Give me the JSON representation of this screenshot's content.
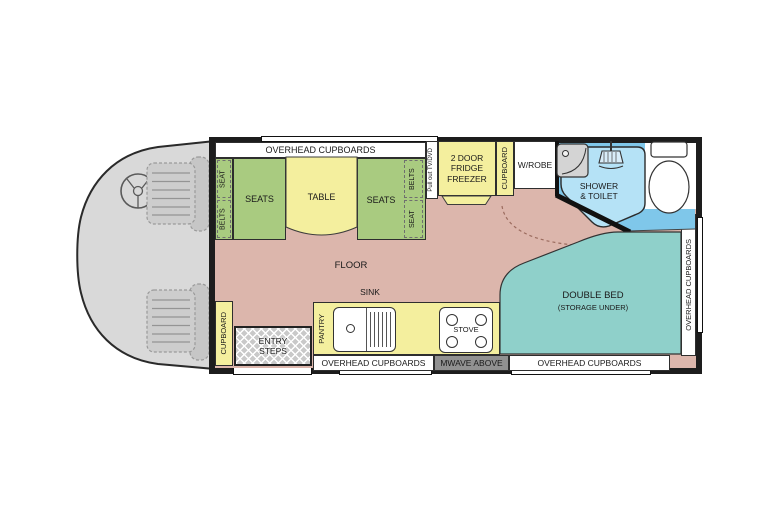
{
  "plan_type": "motorhome-floorplan",
  "labels": {
    "overhead_cupboards": "OVERHEAD CUPBOARDS",
    "seat": "SEAT",
    "belts": "BELTS",
    "seats": "SEATS",
    "table": "TABLE",
    "pullout": "Pull out TV/DVD",
    "fridge": "2 DOOR\nFRIDGE\nFREEZER",
    "cupboard": "CUPBOARD",
    "wrobe": "W/ROBE",
    "shower": "SHOWER\n& TOILET",
    "floor": "FLOOR",
    "sink": "SINK",
    "pantry": "PANTRY",
    "stove": "STOVE",
    "entry": "ENTRY\nSTEPS",
    "mwave": "MWAVE ABOVE",
    "double_bed": "DOUBLE BED",
    "storage_under": "(STORAGE UNDER)"
  },
  "colors": {
    "floor": "#dcb6ac",
    "seating_green": "#a9cb80",
    "furniture_yellow": "#f4ef9e",
    "bed_teal": "#8fd0ca",
    "bathroom_blue": "#7fc7ea",
    "shower_tray_blue": "#b5e2f6",
    "cab_gray": "#d9d9d9",
    "wall_black": "#1d1d1d",
    "mwave_gray": "#919191"
  }
}
